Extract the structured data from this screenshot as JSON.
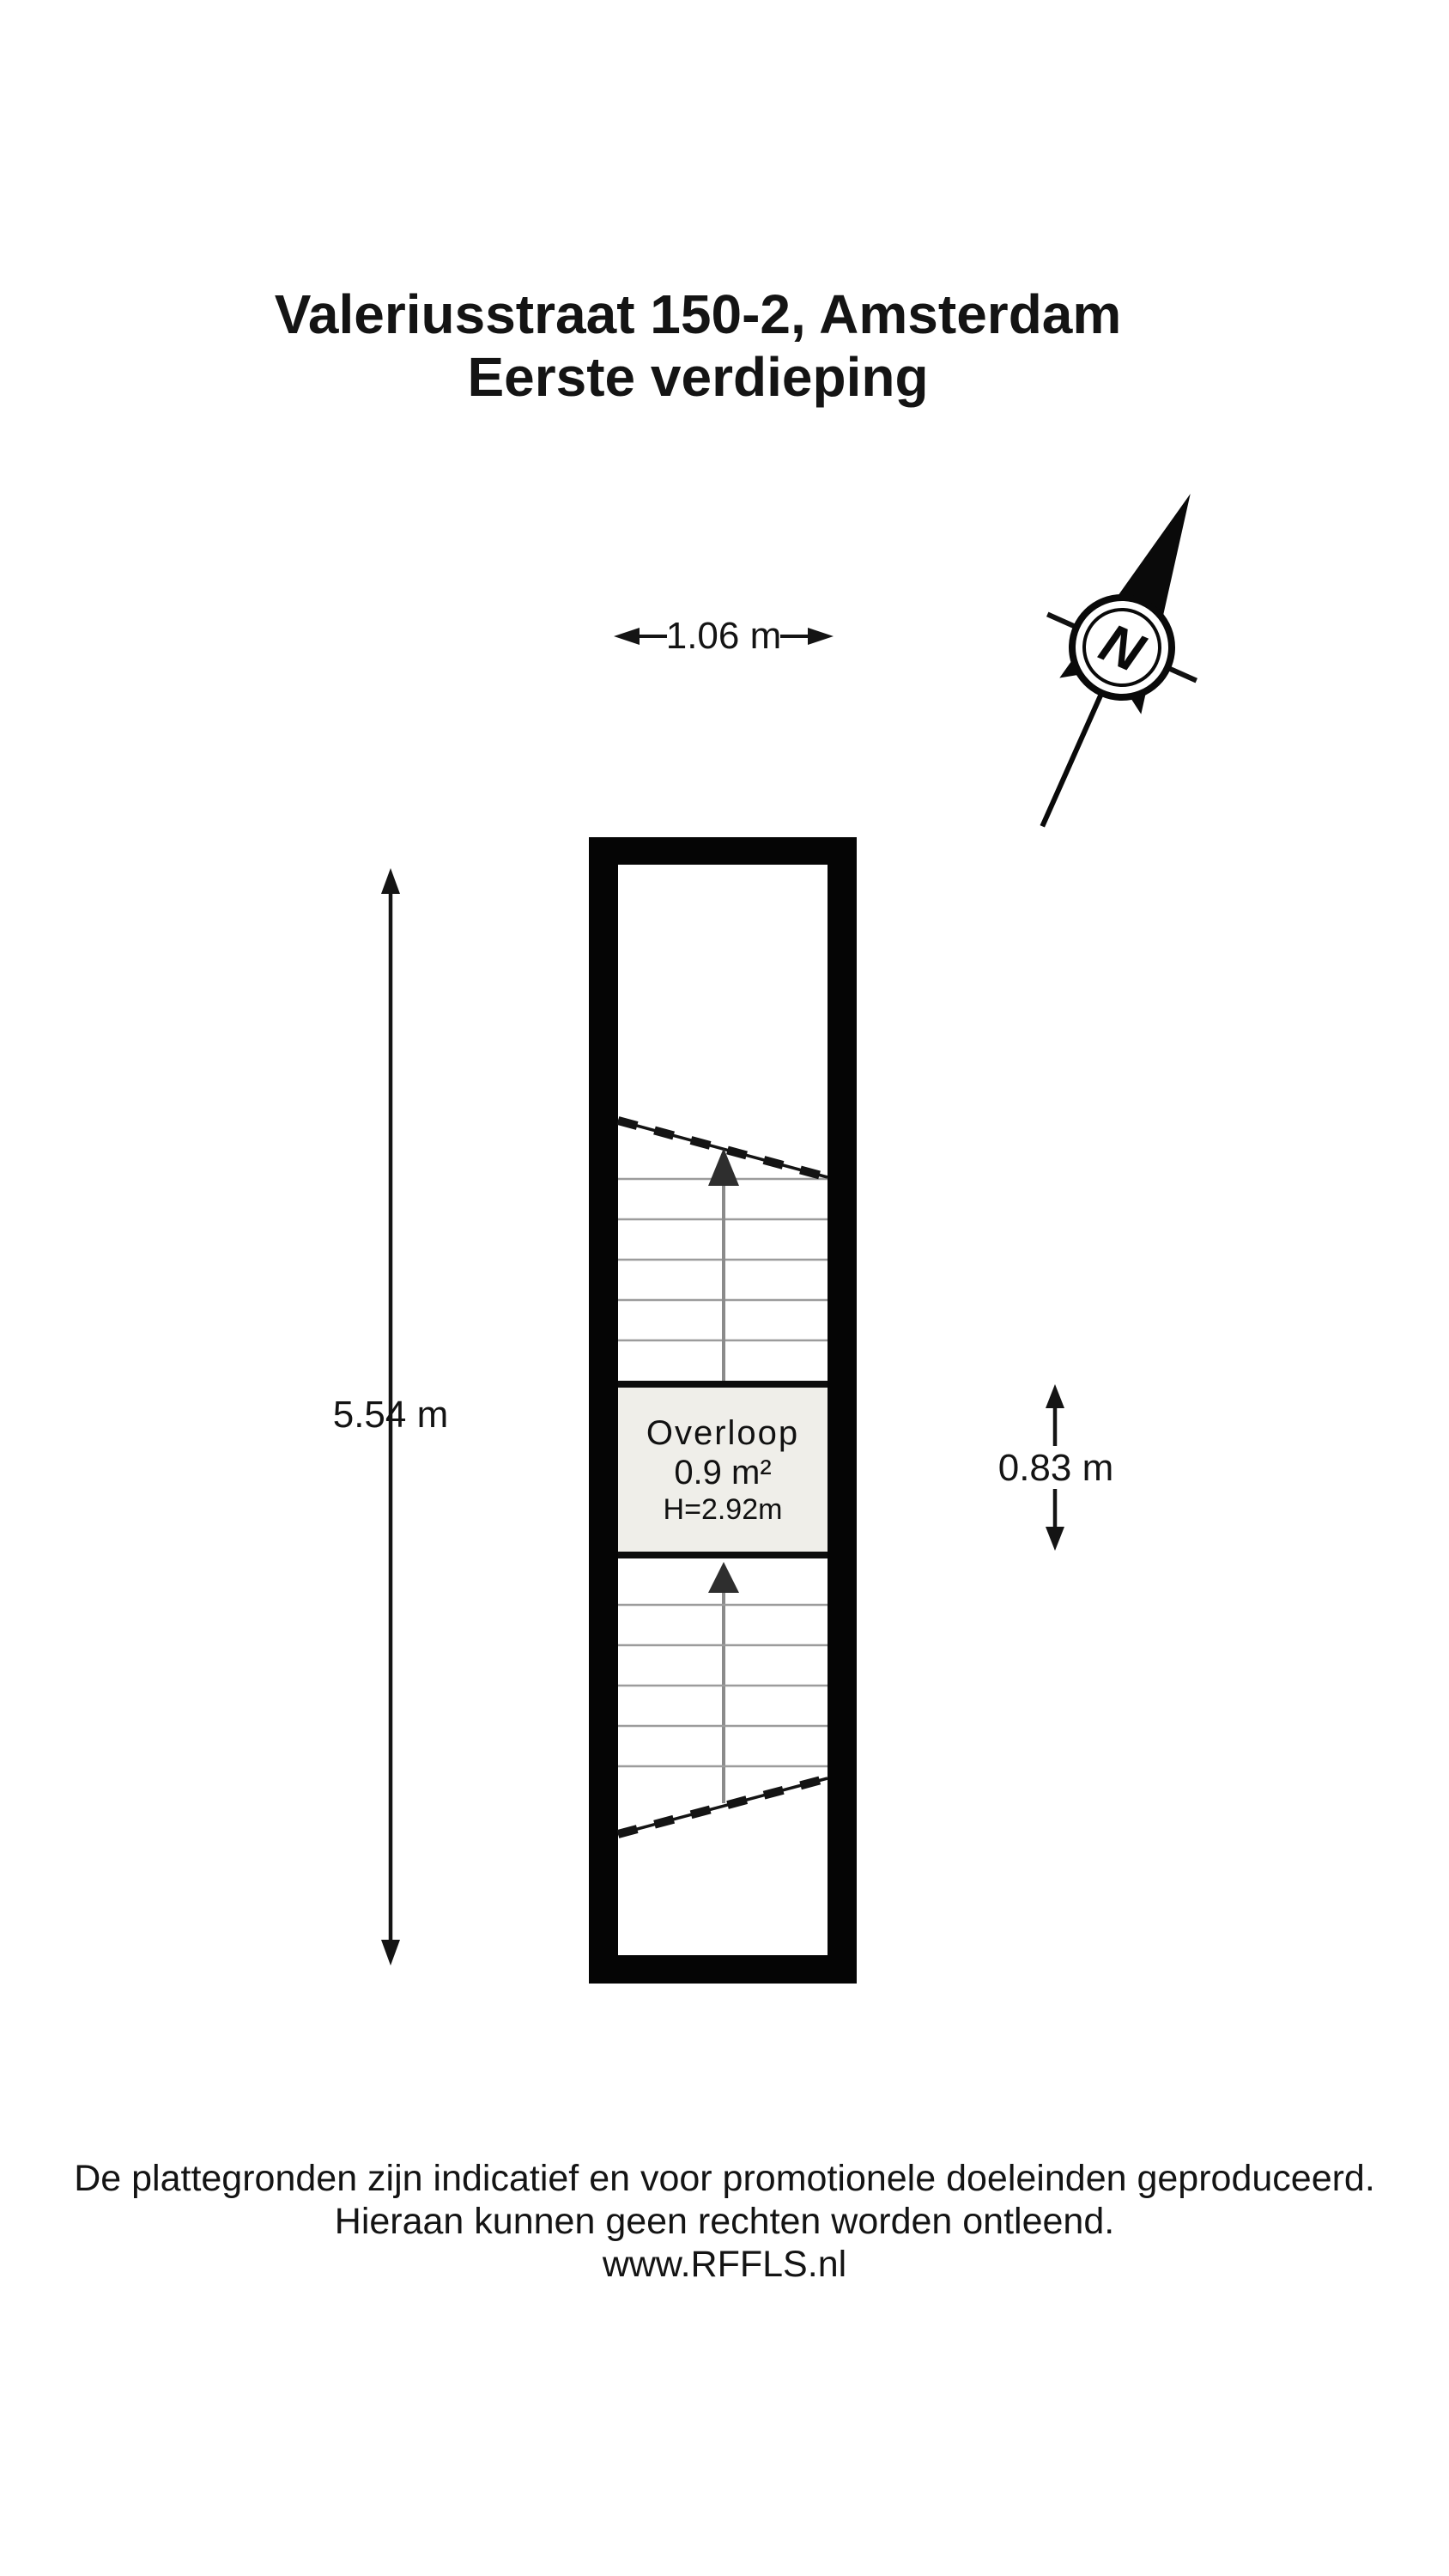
{
  "title": {
    "line1": "Valeriusstraat 150-2, Amsterdam",
    "line2": "Eerste verdieping"
  },
  "compass": {
    "label": "N"
  },
  "dimensions": {
    "width_top": "1.06 m",
    "height_left": "5.54 m",
    "height_right": "0.83 m"
  },
  "room": {
    "name": "Overloop",
    "area": "0.9 m²",
    "ceiling_height": "H=2.92m"
  },
  "footer": {
    "line1": "De plattegronden zijn indicatief en voor promotionele doeleinden geproduceerd.",
    "line2": "Hieraan kunnen geen rechten worden ontleend.",
    "line3": "www.RFFLS.nl"
  },
  "colors": {
    "wall": "#050505",
    "room_fill": "#efeee9",
    "tread": "#9c9c9c",
    "stair_arrow": "#2e2e2e",
    "text": "#141414",
    "background": "#ffffff"
  }
}
